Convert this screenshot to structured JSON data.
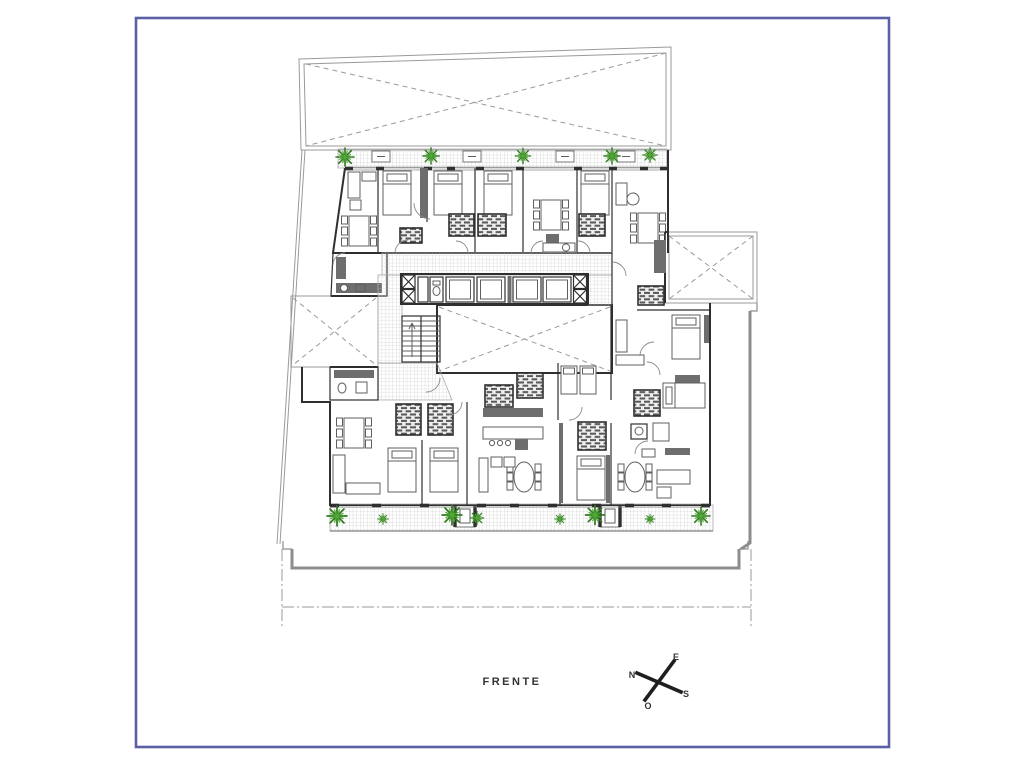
{
  "labels": {
    "front": "FRENTE"
  },
  "compass": {
    "east": "E",
    "north": "N",
    "south": "S",
    "west": "O"
  },
  "colors": {
    "frame": "#5a5fa6",
    "paper": "#ffffff",
    "wall": "#2f2f2f",
    "mid": "#5c5c5c",
    "boundary": "#8d8d8d",
    "line": "#9a9a9a",
    "hatchline": "#c2c2c2",
    "brick": "#575757",
    "darkfill": "#6e6e6e",
    "furn": "#5f5f5f",
    "plantdark": "#2e7d1d",
    "plantlight": "#52a838",
    "text": "#333333"
  }
}
